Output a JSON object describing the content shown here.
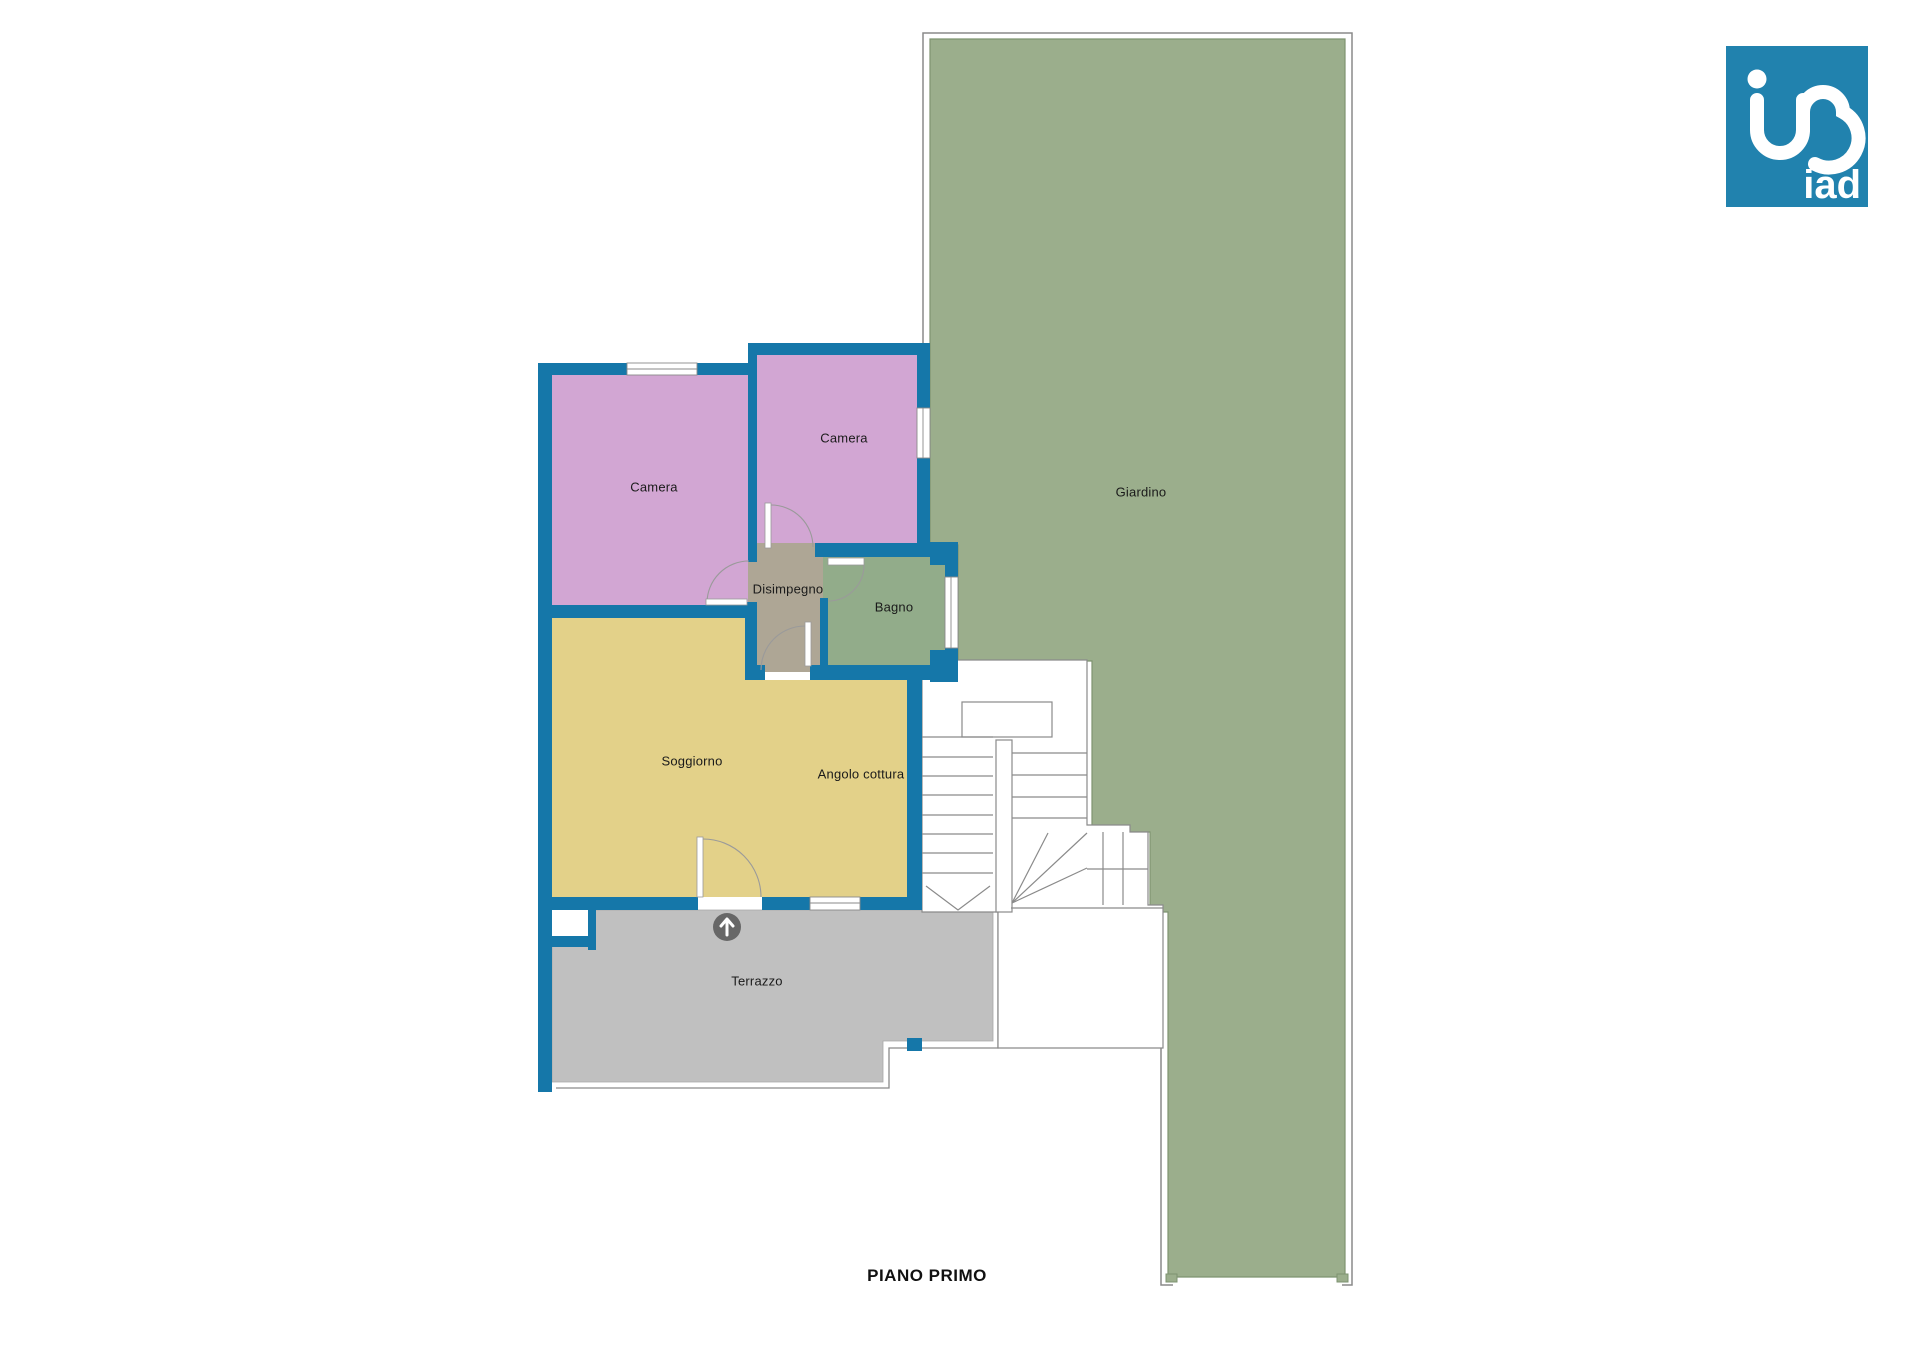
{
  "page": {
    "title": "PIANO PRIMO"
  },
  "logo": {
    "text": "iad",
    "bg_color": "#2182AE",
    "glyph": "ino-monogram-icon"
  },
  "plan": {
    "wall_color": "#1577A9",
    "outline_color": "#8A8A8A",
    "label_color": "#1a1a1a",
    "entrance_icon": "arrow-up",
    "entrance_icon_color": "#676767",
    "rooms": {
      "camera1": {
        "label": "Camera",
        "color": "#D2A6D3"
      },
      "camera2": {
        "label": "Camera",
        "color": "#D2A6D3"
      },
      "disimpegno": {
        "label": "Disimpegno",
        "color": "#AEA695"
      },
      "bagno": {
        "label": "Bagno",
        "color": "#92AC8A"
      },
      "soggiorno": {
        "label": "Soggiorno",
        "color": "#E3D189"
      },
      "angolo_cottura": {
        "label": "Angolo cottura"
      },
      "terrazzo": {
        "label": "Terrazzo",
        "color": "#C0C0C0"
      },
      "giardino": {
        "label": "Giardino",
        "color": "#9BAE8C"
      }
    }
  }
}
